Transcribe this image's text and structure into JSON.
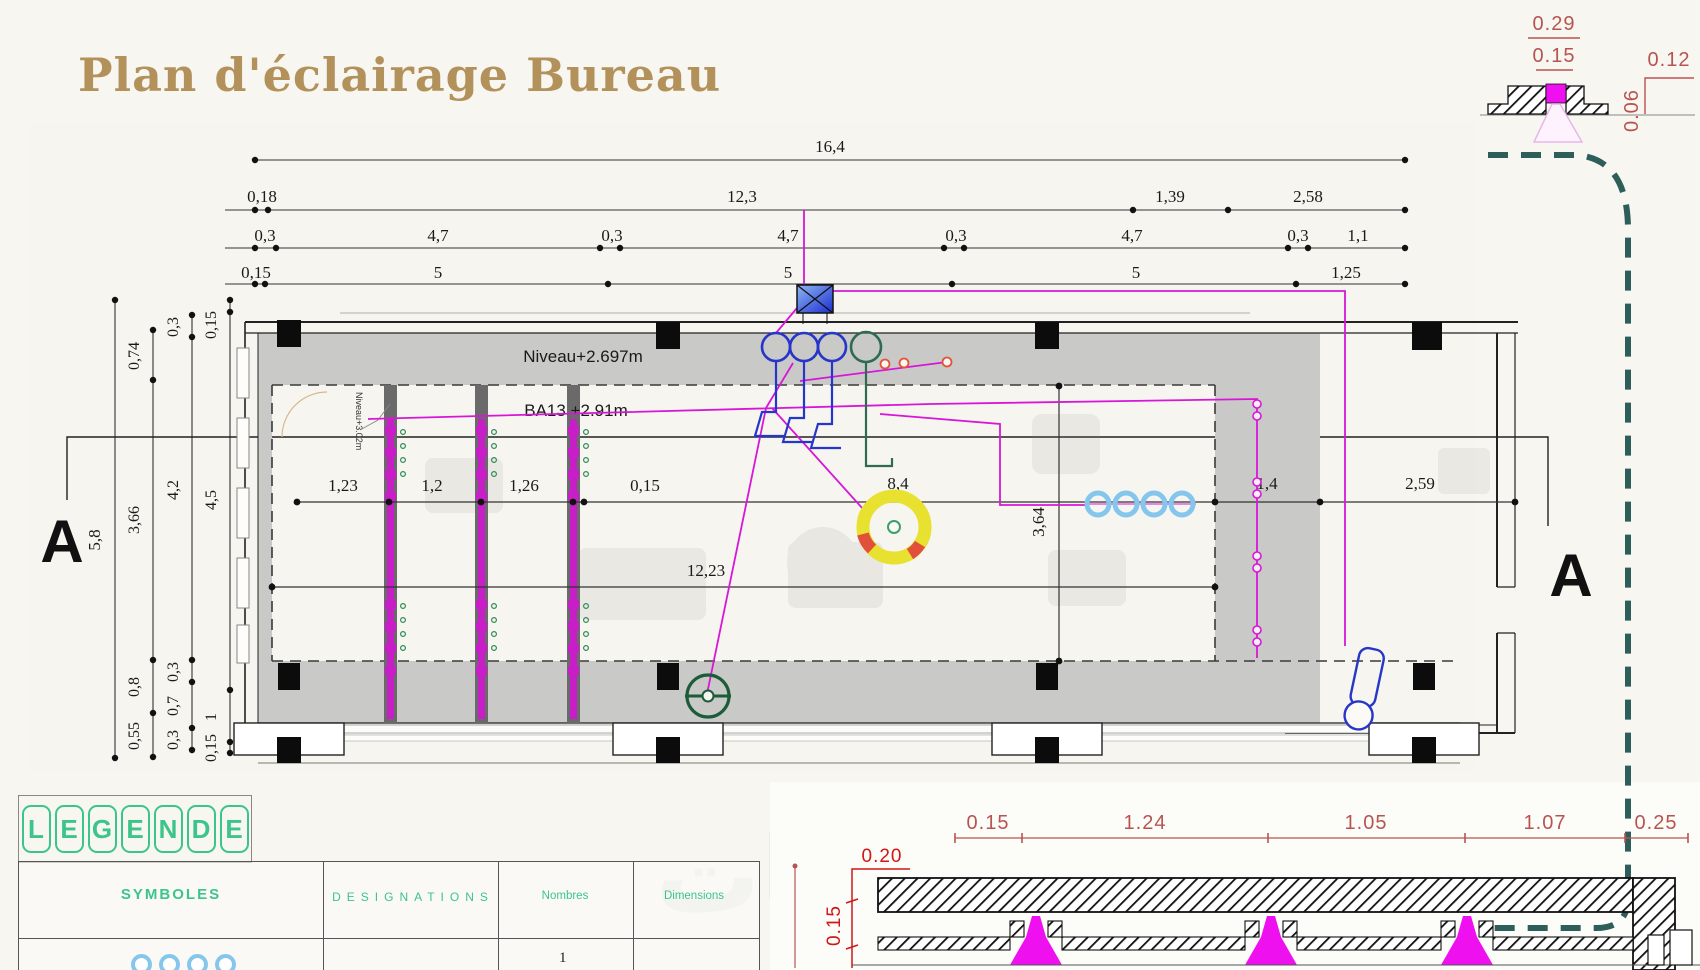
{
  "title": "Plan d'éclairage Bureau",
  "watermark": "خطبات",
  "colors": {
    "title_tan": "#b3915a",
    "circuit_magenta": "#d816d8",
    "section_teal_dashed": "#2e5e5a",
    "legend_green": "#3cc58a",
    "detail_red": "#b85450",
    "detail_bright_red": "#d01616",
    "pendant_yellow": "#e8e12f",
    "fixture_blue": "#2636c8",
    "fixture_dark_green": "#1d5c38",
    "spot_light_blue": "#85c7ec",
    "soffit_gray": "#c9c9c8"
  },
  "top_dims": {
    "total": "16,4",
    "row2": [
      "0,18",
      "12,3",
      "1,39",
      "2,58"
    ],
    "row3": [
      "0,3",
      "4,7",
      "0,3",
      "4,7",
      "0,3",
      "4,7",
      "0,3",
      "1,1"
    ],
    "row4": [
      "0,15",
      "5",
      "5",
      "5",
      "1,25"
    ]
  },
  "left_dims": {
    "total": "5,8",
    "col2": [
      "0,74",
      "3,66",
      "0,8",
      "0,55"
    ],
    "col3": [
      "0,3",
      "4,2",
      "0,3",
      "0,7",
      "0,3"
    ],
    "col4": [
      "0,15",
      "4,5",
      "1",
      "0,15"
    ]
  },
  "section": {
    "marker": "A"
  },
  "plan": {
    "ceiling_level": "Niveau+2.697m",
    "wall_level": "Niveau+3.02m",
    "ba13": "BA13 +2.91m",
    "interior_dims": [
      "1,23",
      "1,2",
      "1,26",
      "0,15",
      "8,4",
      "1,4",
      "2,59"
    ],
    "length_dim": "12,23",
    "width_dim": "3,64"
  },
  "detail_top_right": {
    "dim_029": "0.29",
    "dim_015": "0.15",
    "dim_012": "0.12",
    "dim_006": "0.06"
  },
  "detail_bottom_right": {
    "dims_row": [
      "0.15",
      "1.24",
      "1.05",
      "1.07",
      "0.25"
    ],
    "dim_020": "0.20",
    "dim_015_vertical": "0.15"
  },
  "legend": {
    "title_letters": [
      "L",
      "E",
      "G",
      "E",
      "N",
      "D",
      "E"
    ],
    "headers": [
      "SYMBOLES",
      "DESIGNATIONS",
      "Nombres",
      "Dimensions"
    ],
    "row1_count": "1"
  }
}
